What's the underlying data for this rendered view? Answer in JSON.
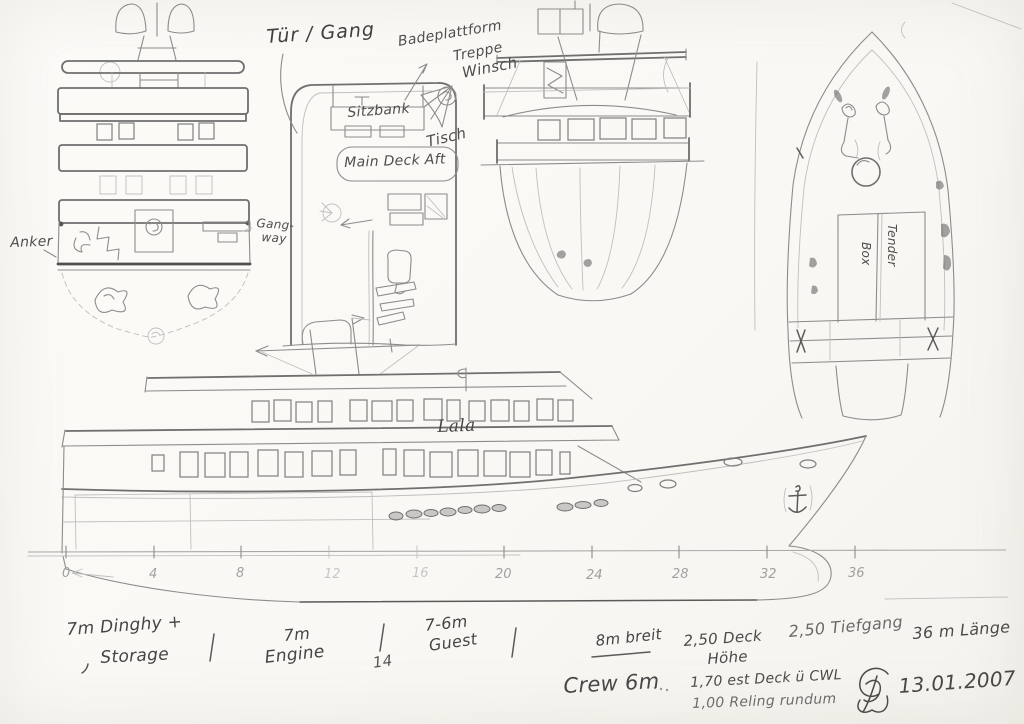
{
  "views": {
    "stern_view": {
      "anker_label": "Anker",
      "gangway_label_line1": "Gang-",
      "gangway_label_line2": "way"
    },
    "aft_deck_plan": {
      "tuer_gang_label": "Tür / Gang",
      "badeplattform_label": "Badeplattform",
      "treppe_label": "Treppe",
      "winsch_label": "Winsch",
      "sitzbank_label": "Sitzbank",
      "tisch_label": "Tisch",
      "main_deck_aft_label": "Main Deck Aft"
    },
    "bow_plan": {
      "tender_label": "Tender",
      "box_label": "Box"
    },
    "side_profile": {
      "boat_name": "Lala"
    }
  },
  "scale": {
    "ticks": [
      "0",
      "4",
      "8",
      "12",
      "16",
      "20",
      "24",
      "28",
      "32",
      "36"
    ]
  },
  "annotations": {
    "dinghy_line1": "7m Dinghy +",
    "dinghy_line2": "Storage",
    "engine_length": "7m",
    "engine_label": "Engine",
    "station_14": "14",
    "guest_length": "7-6m",
    "guest_label": "Guest",
    "beam": "8m breit",
    "deck_height_line1": "2,50 Deck",
    "deck_height_line2": "Höhe",
    "draft": "2,50 Tiefgang",
    "length": "36 m Länge",
    "crew": "Crew 6m",
    "deck_above_cwl": "1,70 est Deck ü CWL",
    "railing": "1,00 Reling rundum",
    "date": "13.01.2007"
  }
}
